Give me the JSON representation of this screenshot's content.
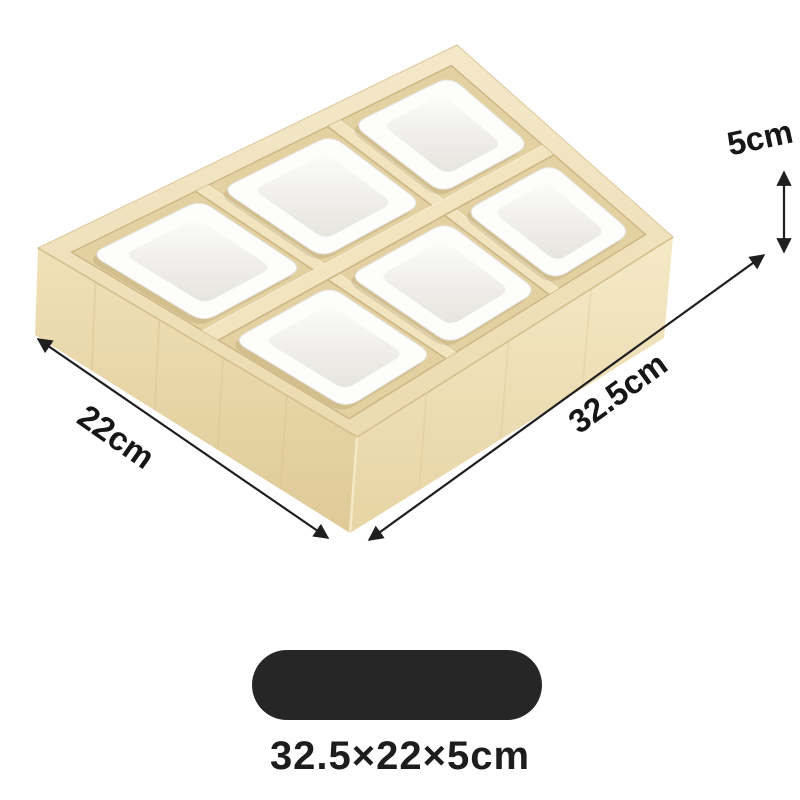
{
  "product": {
    "caption": "32.5×22×5cm",
    "dimensions": {
      "depth_label": "5cm",
      "width_label": "22cm",
      "length_label": "32.5cm"
    }
  },
  "icons": {
    "depth_arrow": "double-headed-vertical-arrow",
    "width_arrow": "double-headed-diagonal-arrow",
    "length_arrow": "double-headed-diagonal-arrow"
  },
  "colors": {
    "background": "#ffffff",
    "wood_top_light": "#f4e8c9",
    "wood_top_dark": "#ecdbb0",
    "wood_left_top": "#f0e1b8",
    "wood_left_bottom": "#dfca97",
    "wood_right_top": "#f5e9c7",
    "wood_right_bottom": "#e7d4a4",
    "wood_inner": "#e4d1a2",
    "wood_divider": "#f1e4bf",
    "wood_edge": "#cdb584",
    "wood_grain": "#d9c28e",
    "dish_white": "#fdfdfc",
    "dish_wall_light": "#fbfbf9",
    "dish_wall_mid": "#f1f0ec",
    "dish_floor": "#e6e5e0",
    "dish_outline": "#e4e3df",
    "dish_shadow": "rgba(150,125,75,0.22)",
    "arrow": "#1f1f1f",
    "label_text": "#161616",
    "pill": "#262626"
  }
}
